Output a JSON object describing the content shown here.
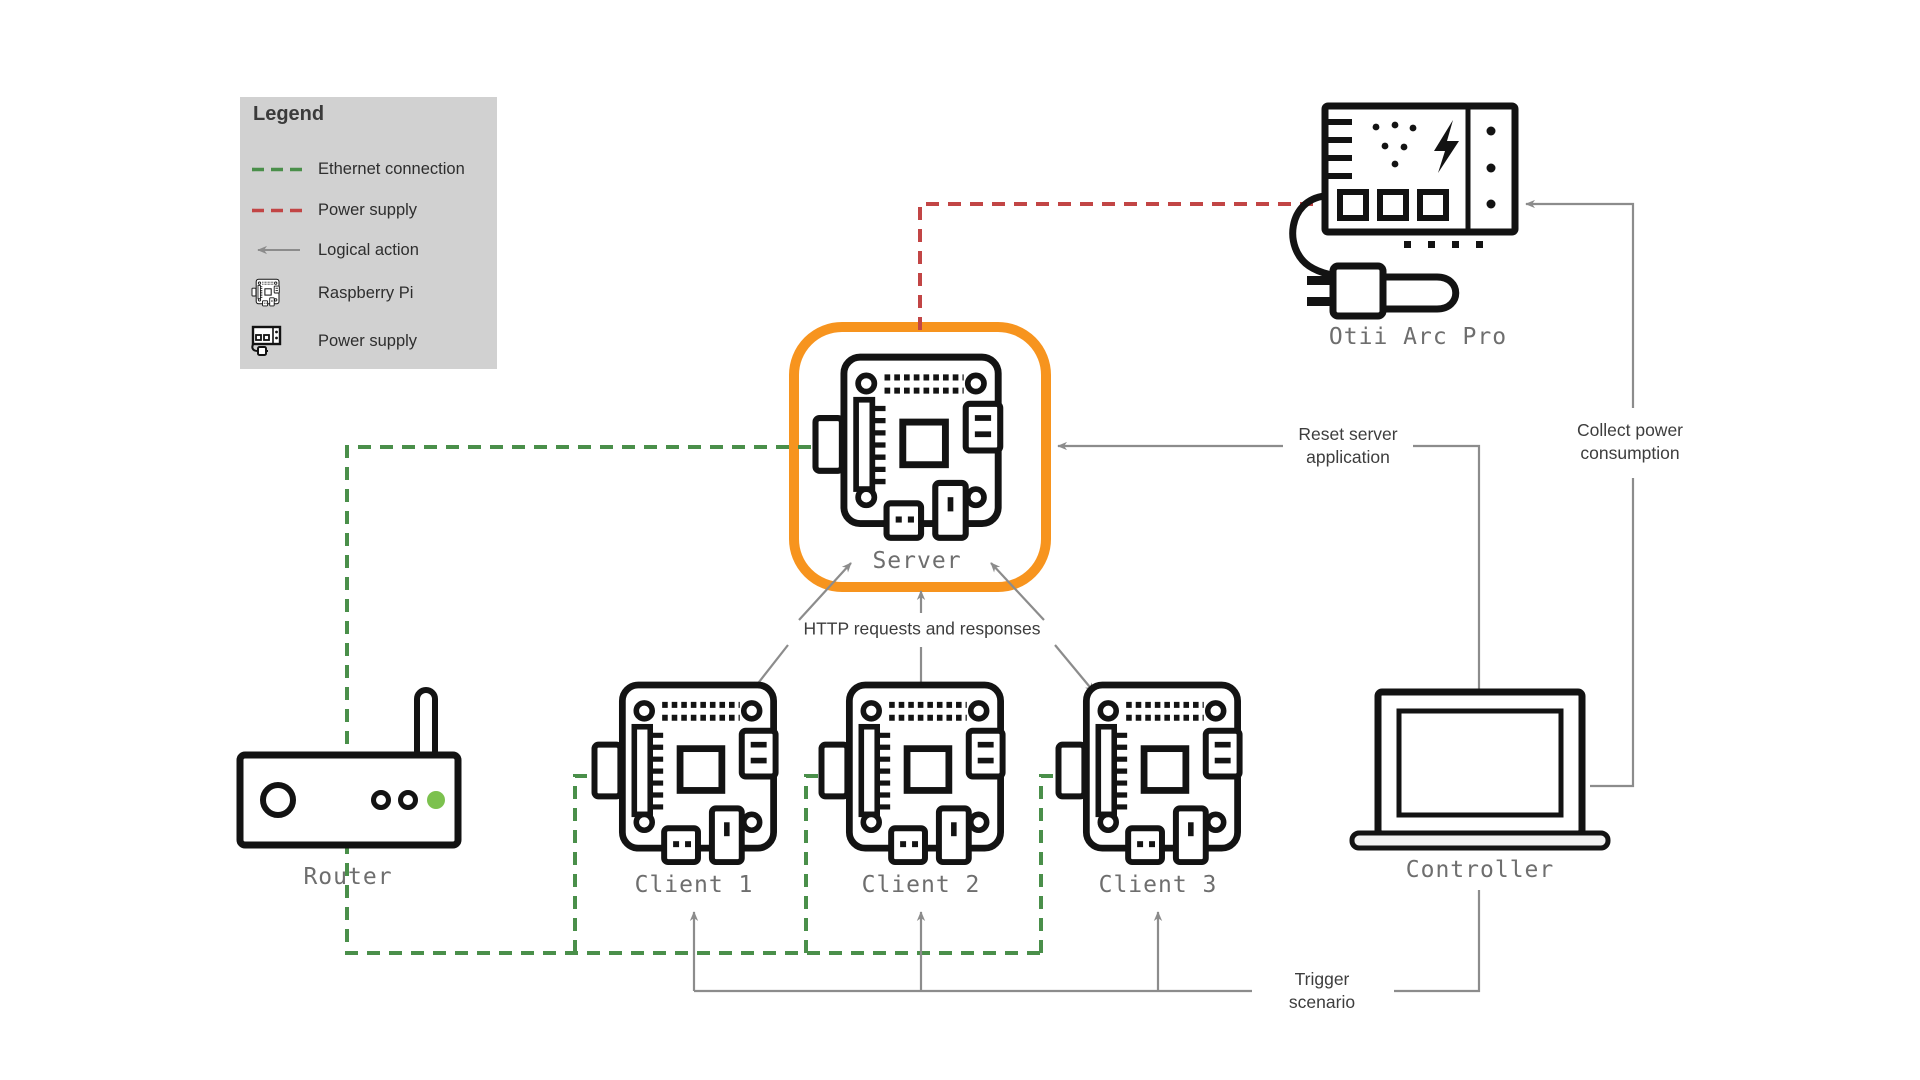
{
  "legend": {
    "title": "Legend",
    "items": [
      {
        "label": "Ethernet connection",
        "swatch": "green-dashed-line"
      },
      {
        "label": "Power supply",
        "swatch": "red-dashed-line"
      },
      {
        "label": "Logical action",
        "swatch": "gray-arrow"
      },
      {
        "label": "Raspberry Pi",
        "swatch": "raspberry-pi-icon"
      },
      {
        "label": "Power supply",
        "swatch": "power-supply-icon"
      }
    ]
  },
  "devices": {
    "server": {
      "label": "Server",
      "highlighted": true
    },
    "client1": {
      "label": "Client 1"
    },
    "client2": {
      "label": "Client 2"
    },
    "client3": {
      "label": "Client 3"
    },
    "router": {
      "label": "Router"
    },
    "controller": {
      "label": "Controller"
    },
    "otii": {
      "label": "Otii Arc Pro"
    }
  },
  "annotations": {
    "http": {
      "text": "HTTP requests and responses"
    },
    "reset": {
      "line1": "Reset server",
      "line2": "application"
    },
    "collect": {
      "line1": "Collect power",
      "line2": "consumption"
    },
    "trigger": {
      "line1": "Trigger",
      "line2": "scenario"
    }
  },
  "connections": [
    {
      "type": "ethernet",
      "from": "router",
      "to": "server"
    },
    {
      "type": "ethernet",
      "from": "router",
      "to": "client1"
    },
    {
      "type": "ethernet",
      "from": "router",
      "to": "client2"
    },
    {
      "type": "ethernet",
      "from": "router",
      "to": "client3"
    },
    {
      "type": "power",
      "from": "otii",
      "to": "server"
    },
    {
      "type": "logical",
      "from": "controller",
      "to": "server",
      "label": "Reset server application"
    },
    {
      "type": "logical",
      "from": "controller",
      "to": "otii",
      "label": "Collect power consumption"
    },
    {
      "type": "logical",
      "from": "controller",
      "to": "clients",
      "label": "Trigger scenario"
    },
    {
      "type": "logical",
      "from": "clients",
      "to": "server",
      "label": "HTTP requests and responses",
      "bidirectional": true
    }
  ],
  "colors": {
    "ethernet_green": "#4a8f4a",
    "power_red": "#c24545",
    "action_gray": "#8c8c8c",
    "highlight_orange": "#f7941e",
    "icon_black": "#131313",
    "label_gray": "#6e6e6e",
    "legend_bg": "#d1d1d1",
    "router_led_green": "#7cc14e"
  }
}
